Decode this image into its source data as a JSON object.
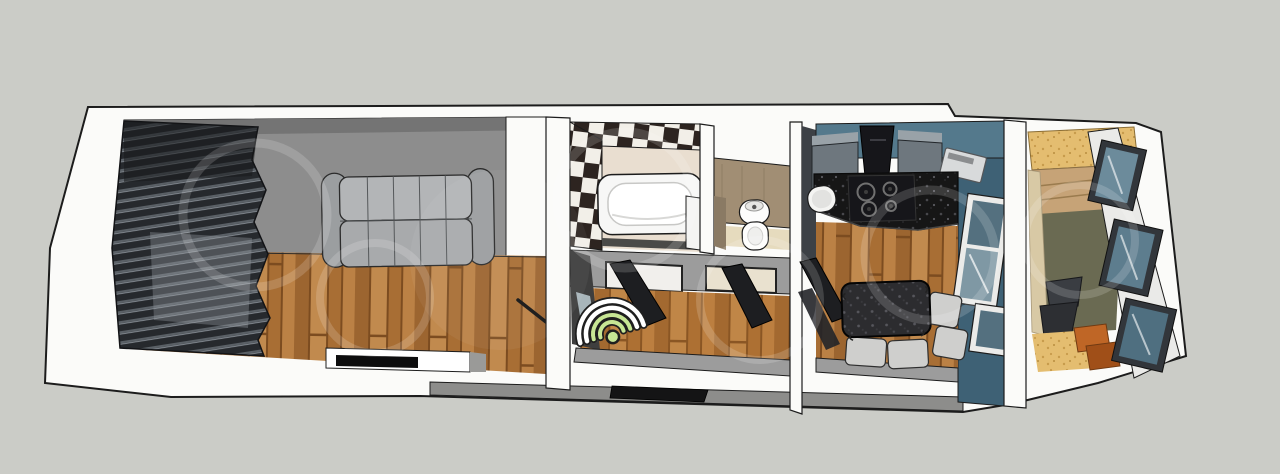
{
  "canvas": {
    "width": 1280,
    "height": 474
  },
  "scene": {
    "kind": "3d-floor-plan-cutaway-render",
    "rooms": [
      "living-room",
      "bathroom",
      "toilet",
      "hallway",
      "kitchen",
      "balcony"
    ],
    "furniture": {
      "living_room": [
        "window-blinds",
        "wall-shelf",
        "sofa",
        "tv"
      ],
      "bathroom": [
        "checkerboard-tile-wall",
        "bathtub",
        "glass-partition"
      ],
      "toilet": [
        "toilet"
      ],
      "hallway": [
        "wifi-marker",
        "open-door",
        "open-door",
        "entrance-door"
      ],
      "kitchen": [
        "upper-cabinets",
        "range-hood",
        "cooktop",
        "granite-counter",
        "sink",
        "microwave",
        "dining-table",
        "chairs",
        "window"
      ],
      "balcony": [
        "stacked-windows",
        "desk-chair",
        "wooden-steps"
      ]
    },
    "icons": {
      "wifi": "wifi-signal-icon"
    }
  },
  "colors": {
    "background": "#cbccc7",
    "outline": "#1c1c1c",
    "wall_white": "#fbfbf9",
    "wall_top_gray": "#9c9c9c",
    "south_face_gray": "#8d8d8b",
    "living_wall_gray": "#8d8d8d",
    "blinds_dark": "#26292d",
    "blinds_slat": "#5a6066",
    "floor_base": "#b0763c",
    "floor_dark": "#9c6530",
    "floor_light": "#c18a4e",
    "floor_seam": "#7c4c20",
    "sofa_back": "#b3b5b7",
    "sofa_seat": "#a8aaac",
    "sofa_arm": "#9b9ea0",
    "tv_black": "#0d0d0e",
    "checker_dark": "#2d2420",
    "checker_light": "#f2efe8",
    "bath_floor": "#e9ded0",
    "tub_white": "#f7f7f6",
    "wc_wall_tan": "#a18e74",
    "wc_wall_tan_dark": "#8a7a64",
    "wc_floor": "#e6dbbe",
    "toilet_white": "#fdfdfc",
    "door_dark": "#1d1e21",
    "door_frame_light": "#f1efec",
    "hall_left_dark": "#3e3e3e",
    "kitchen_teal": "#54798c",
    "kitchen_teal_dark": "#3e6175",
    "kitchen_wall_dark": "#3d4146",
    "cabinet_front": "#6e777e",
    "cabinet_top": "#99a2a8",
    "hood_black": "#16161a",
    "counter_granite": "#161616",
    "table_granite": "#2c2c2f",
    "appliance_silver": "#d8dadb",
    "sink_white": "#f4f4f2",
    "chair_light": "#cfcfcd",
    "window_glass": "#54707f",
    "window_glass_light": "#7f98a4",
    "balcony_glass": "#5d7d8e",
    "window_frame_dark": "#32363b",
    "balcony_sand": "#e4bd70",
    "balcony_sand_dot": "#c79b4b",
    "balcony_wood": "#c6a377",
    "balcony_olive": "#6a6a52",
    "balcony_beige": "#d8c9a5",
    "balcony_chair": "#3a3d42",
    "step_orange": "#bf6626",
    "step_orange_dark": "#a04f18",
    "entry_door": "#141415",
    "wifi_white": "#ffffff",
    "wifi_green": "#c7e694",
    "wifi_outline": "#1f1f1f",
    "watermark_ring": "rgba(255,255,255,0.16)"
  }
}
